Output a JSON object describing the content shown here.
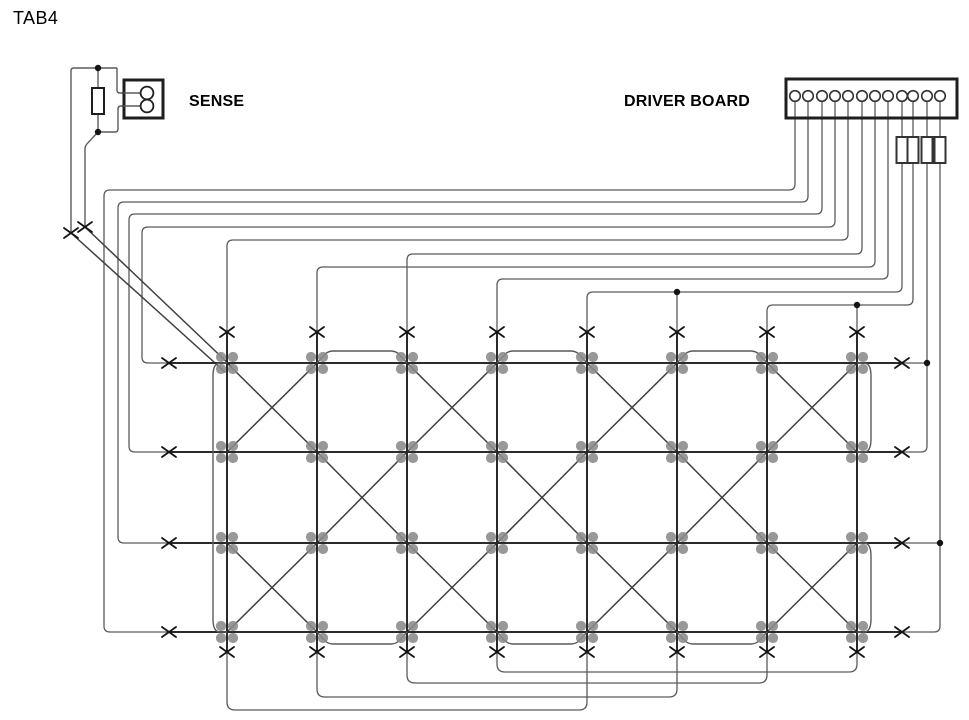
{
  "page": {
    "title": "TAB4"
  },
  "labels": {
    "sense": "SENSE",
    "driver_board": "DRIVER BOARD"
  },
  "colors": {
    "background": "#ffffff",
    "text": "#000000",
    "wire": "#5a5a5a",
    "diagonal": "#3f3f3f",
    "grid": "#2a2a2a",
    "node": "#8a8a8a",
    "junction": "#141414",
    "outline": "#1e1e1e",
    "component_fill": "#ffffff"
  },
  "canvas": {
    "width": 969,
    "height": 720
  },
  "grid": {
    "col_x": [
      227,
      317,
      407,
      497,
      587,
      677,
      767,
      857
    ],
    "row_y": [
      363,
      452,
      543,
      632
    ],
    "x_top_y": 332,
    "x_bottom_y": 652,
    "row_left_x": 169,
    "row_right_x": 902,
    "diag_bands": [
      [
        0,
        2,
        4,
        6
      ],
      [
        1,
        3,
        5
      ],
      [
        0,
        2,
        4,
        6
      ]
    ],
    "bridge_pairs": [
      [
        1,
        2
      ],
      [
        3,
        4
      ],
      [
        5,
        6
      ]
    ],
    "bridge_rise": 12,
    "bridge_shoulder": 11,
    "left_bracket_x": 213,
    "right_bracket_x": 871,
    "right_bracket_rows": [
      [
        0,
        1
      ],
      [
        2,
        3
      ]
    ],
    "bottom_loops": [
      {
        "a": 0,
        "b": 4,
        "y": 710
      },
      {
        "a": 1,
        "b": 5,
        "y": 697
      },
      {
        "a": 2,
        "b": 6,
        "y": 683
      },
      {
        "a": 3,
        "b": 7,
        "y": 672
      }
    ]
  },
  "driver": {
    "box": {
      "x": 786,
      "y": 79,
      "w": 171,
      "h": 39
    },
    "pin_y": 96,
    "pin_r": 5.3,
    "pin_x": [
      795,
      808,
      822,
      835,
      848,
      862,
      875,
      888,
      902,
      913,
      927,
      940
    ],
    "pin_count": 12,
    "resistors": {
      "pins": [
        8,
        9,
        10,
        11
      ],
      "y1": 137,
      "y2": 163,
      "hw": 5.5
    },
    "left_row_feeds": [
      {
        "pin": 0,
        "hy": 190,
        "vx": 104,
        "row": 3
      },
      {
        "pin": 1,
        "hy": 202,
        "vx": 118,
        "row": 2
      },
      {
        "pin": 2,
        "hy": 214,
        "vx": 129,
        "row": 1
      },
      {
        "pin": 3,
        "hy": 227,
        "vx": 142,
        "row": 0
      }
    ],
    "col_feeds": [
      {
        "pin": 4,
        "hy": 240,
        "col": 0
      },
      {
        "pin": 5,
        "hy": 254,
        "col": 2
      },
      {
        "pin": 6,
        "hy": 267,
        "col": 1
      },
      {
        "pin": 7,
        "hy": 279,
        "col": 3
      },
      {
        "pin": 8,
        "hy": 292,
        "col": 4,
        "tap_col": 5
      },
      {
        "pin": 9,
        "hy": 305,
        "col": 6,
        "tap_col": 7
      }
    ],
    "right_row_feeds": [
      {
        "pin": 10,
        "tap_row": 0,
        "corner_row": 1
      },
      {
        "pin": 11,
        "tap_row": 2,
        "corner_row": 3
      }
    ]
  },
  "sense": {
    "loop": [
      [
        71,
        233
      ],
      [
        71,
        68
      ],
      [
        117,
        68
      ]
    ],
    "top_stub": [
      [
        98,
        68
      ],
      [
        98,
        88
      ]
    ],
    "resistor": {
      "x": 92,
      "y": 88,
      "w": 12,
      "h": 26
    },
    "bottom_stub": [
      [
        98,
        114
      ],
      [
        98,
        132
      ]
    ],
    "bottom_jog": [
      [
        98,
        132
      ],
      [
        118,
        132
      ],
      [
        118,
        106
      ],
      [
        124,
        106
      ]
    ],
    "top_jog": [
      [
        117,
        68
      ],
      [
        117,
        93
      ],
      [
        124,
        93
      ]
    ],
    "descender": [
      [
        98,
        132
      ],
      [
        85,
        146
      ],
      [
        85,
        227
      ]
    ],
    "box": {
      "x": 124,
      "y": 80,
      "w": 39,
      "h": 38
    },
    "pins": [
      {
        "cx": 147,
        "cy": 93
      },
      {
        "cx": 147,
        "cy": 106
      }
    ],
    "pin_wires": [
      [
        [
          124,
          93
        ],
        [
          141,
          93
        ]
      ],
      [
        [
          124,
          106
        ],
        [
          141,
          106
        ]
      ]
    ],
    "junctions": [
      [
        98,
        68
      ],
      [
        98,
        132
      ]
    ],
    "x_marks": [
      [
        71,
        233
      ],
      [
        85,
        227
      ]
    ],
    "diagonals": [
      [
        [
          85,
          227
        ],
        [
          231,
          366
        ]
      ],
      [
        [
          71,
          233
        ],
        [
          225,
          372
        ]
      ]
    ]
  },
  "junction_dots": [
    [
      677,
      292
    ],
    [
      857,
      305
    ],
    [
      927,
      363
    ],
    [
      940,
      543
    ]
  ],
  "x_mark": {
    "arm_x": 7,
    "arm_y": 5
  }
}
